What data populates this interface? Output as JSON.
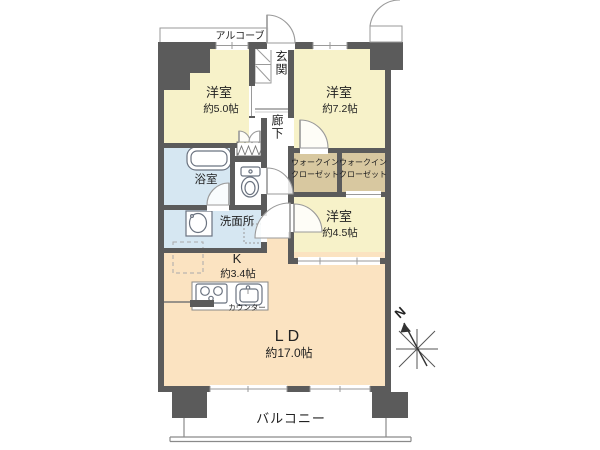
{
  "plan": {
    "alcove": {
      "label": "アルコーブ"
    },
    "entrance": {
      "label": "玄関"
    },
    "corridor": {
      "label": "廊下"
    },
    "bedroom1": {
      "label": "洋室",
      "size": "約5.0帖"
    },
    "bedroom2": {
      "label": "洋室",
      "size": "約7.2帖"
    },
    "bedroom3": {
      "label": "洋室",
      "size": "約4.5帖"
    },
    "wic_left": {
      "line1": "ウォークイン",
      "line2": "クローゼット"
    },
    "wic_right": {
      "line1": "ウォークイン",
      "line2": "クローゼット"
    },
    "bathroom": {
      "label": "浴室"
    },
    "washroom": {
      "label": "洗面所"
    },
    "kitchen": {
      "label": "K",
      "size": "約3.4帖"
    },
    "counter": {
      "label": "カウンター"
    },
    "living_dining": {
      "label": "LD",
      "size": "約17.0帖"
    },
    "balcony": {
      "label": "バルコニー"
    },
    "compass": {
      "north_label": "N"
    }
  },
  "colors": {
    "wall": "#5b5b5b",
    "bedroom_floor": "#f7f2c9",
    "ldk_floor": "#fbe3c1",
    "wet_area_floor": "#d6e7f2",
    "closet_floor": "#d8c8a0",
    "toilet_floor": "#ffffff",
    "balcony_floor": "#ffffff"
  }
}
